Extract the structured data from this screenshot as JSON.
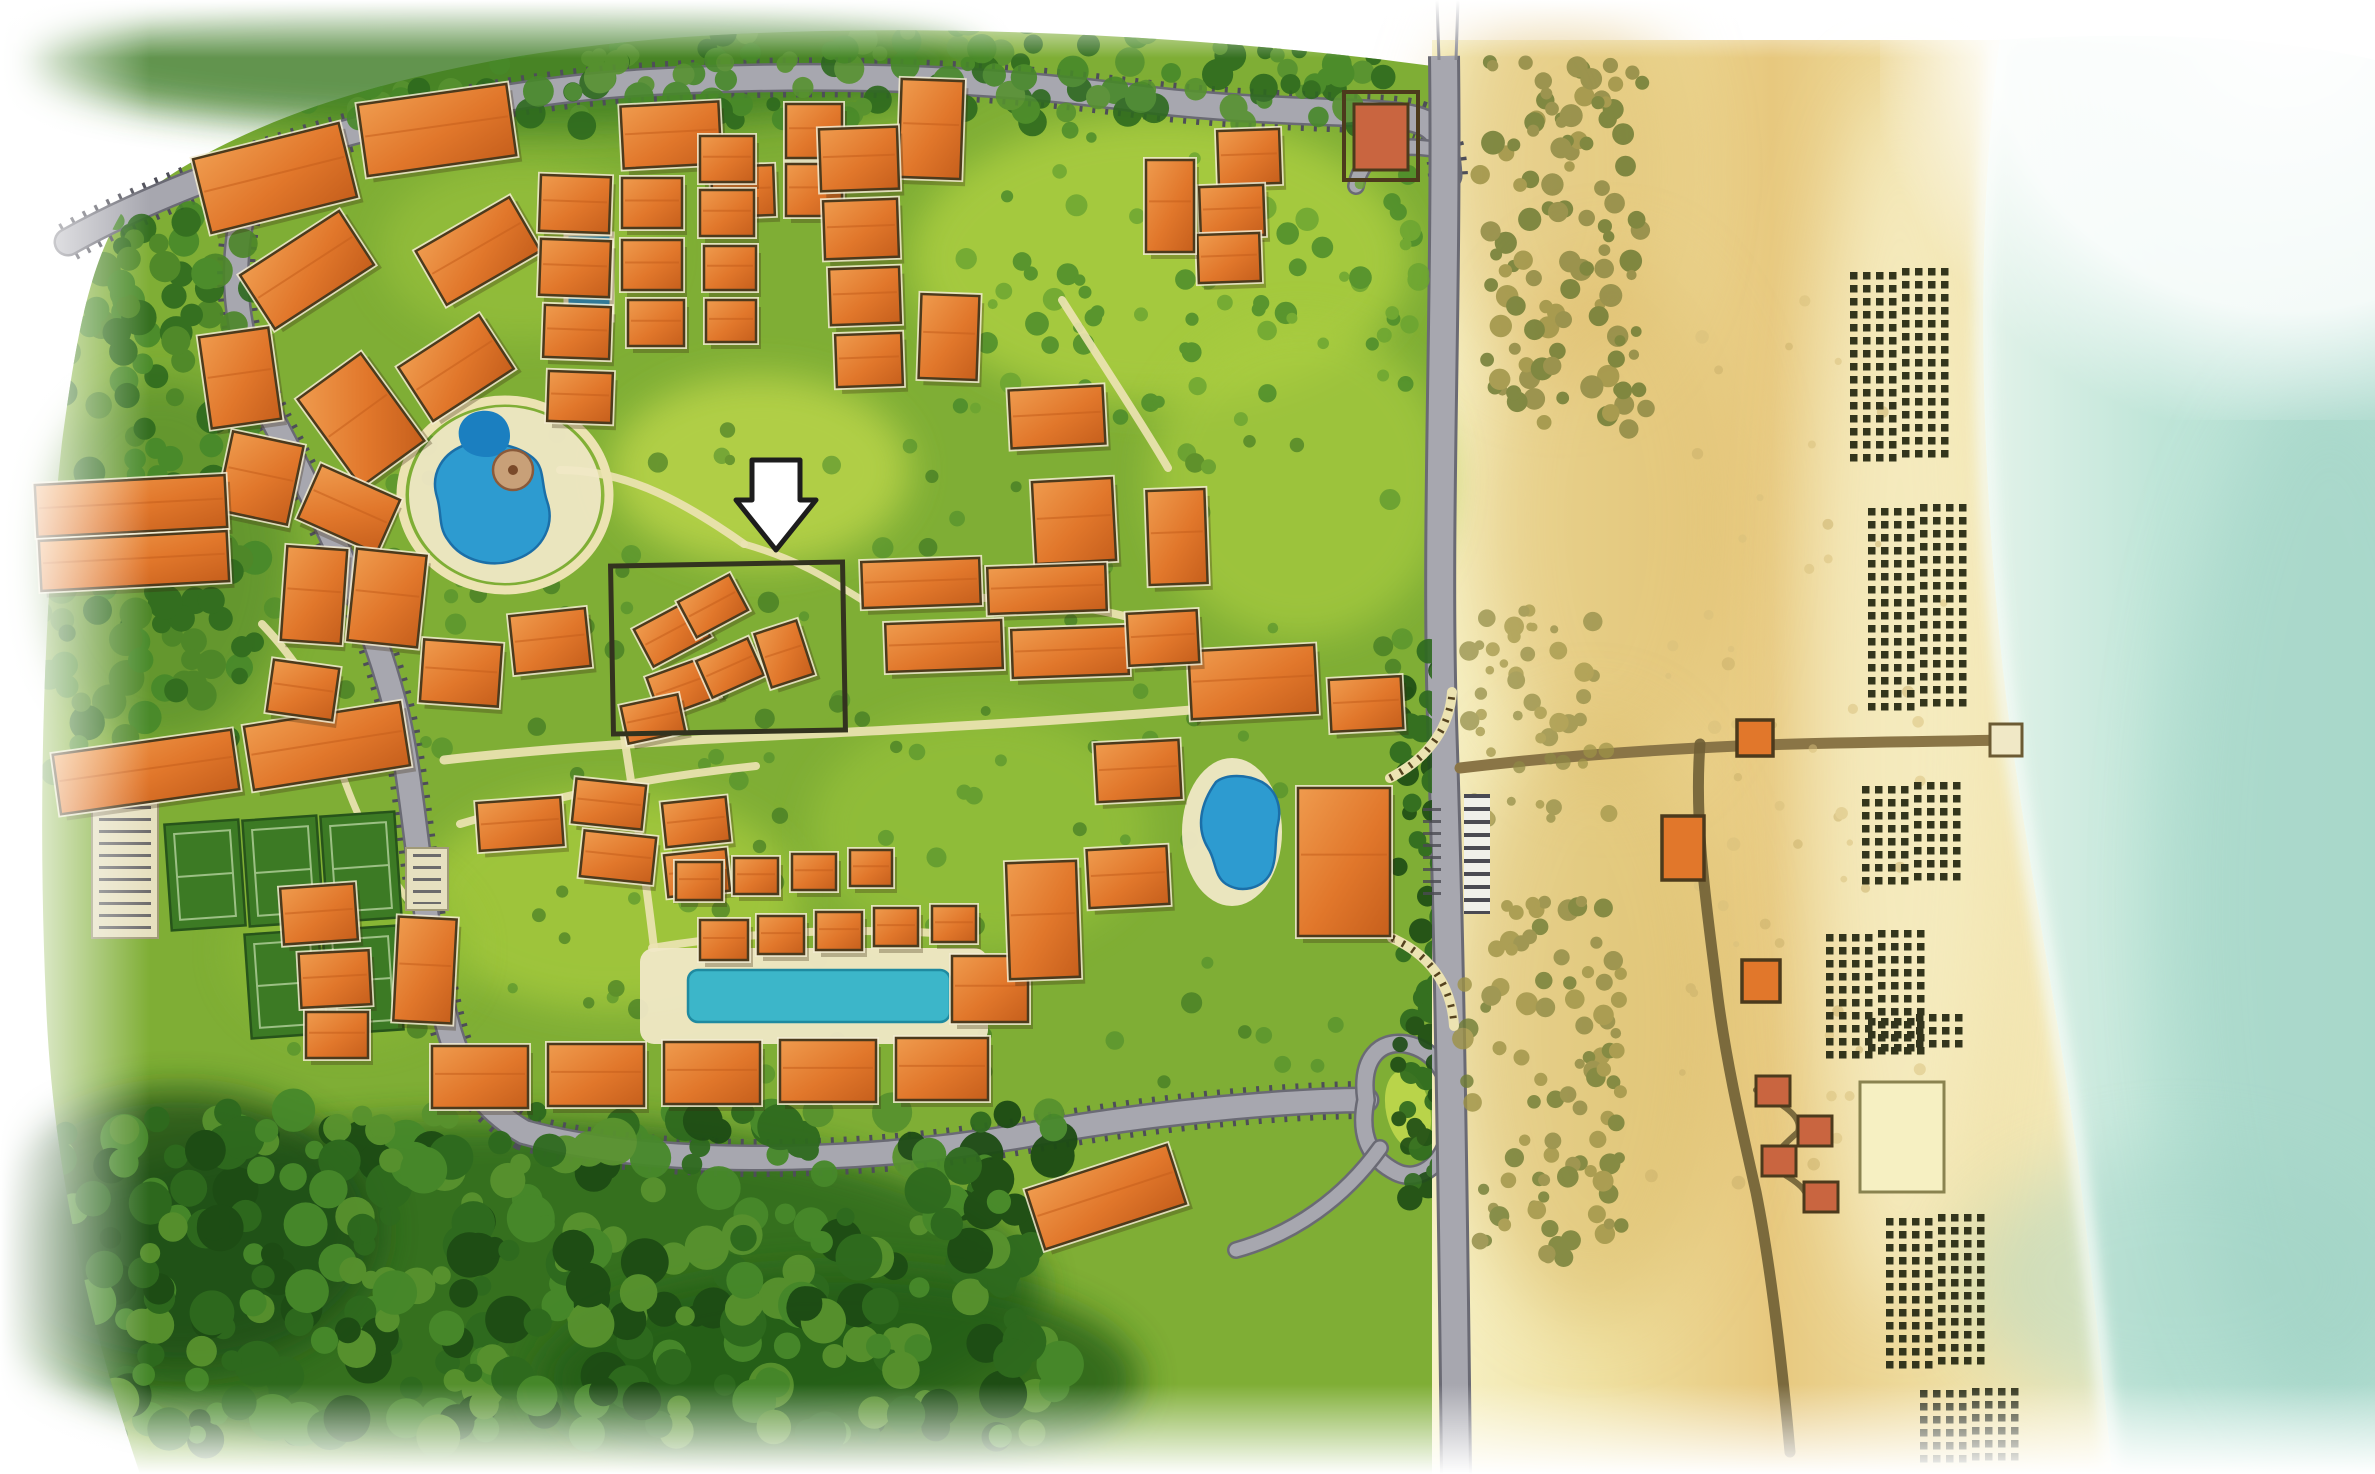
{
  "map": {
    "kind": "illustrated-resort-master-plan",
    "description": "Watercolor aerial site plan of a beachfront resort community with a highlighted parcel marked by a white arrow",
    "annotation": "white-down-arrow-over-highlighted-parcel"
  },
  "colors": {
    "grass": "#7fae35",
    "lawn_bright": "#b9d44a",
    "forest": "#2e6a1e",
    "forest_dark": "#1d4c14",
    "tree": "#47892a",
    "road": "#a7a7af",
    "road_edge": "#6a6a74",
    "park_tick": "#4e4e58",
    "path": "#ece3b2",
    "deck": "#f0e8c6",
    "pool_blue": "#2d9bd0",
    "pool_deep": "#1b6fa8",
    "lap_pool": "#3cb6c9",
    "bldg": "#e1772b",
    "bldg_light": "#ef9b4e",
    "bldg_dark": "#c65f1c",
    "outline": "#4c3a1c",
    "plinth": "#f3ecd2",
    "sand_light": "#f7f2c8",
    "sand_gold": "#e7c87e",
    "dune_olive": "#9e9347",
    "ocean": "#bfe5d8",
    "ocean_deep": "#a5d6c8",
    "foam": "#f4fbf6",
    "umbrella": "#33351c",
    "boardwalk": "#6f5f35",
    "hut": "#c96540",
    "court": "#3c7a24",
    "court_line": "#9cc084",
    "parking_lot": "#e6e0c0",
    "parcel_stroke": "#33331f",
    "arrow_fill": "#ffffff",
    "arrow_stroke": "#1d1d1d"
  },
  "roads": [
    {
      "id": "north-entry-road",
      "d": "M68,242 C200,168 430,94 650,82 C830,72 990,78 1150,100 C1270,114 1370,110 1410,118 C1438,124 1446,138 1448,176",
      "w": 24,
      "ticks": true
    },
    {
      "id": "west-south-loop-road",
      "d": "M252,182 C224,262 234,342 274,422 C320,510 368,602 394,702 C412,770 418,882 438,982 C452,1058 472,1102 524,1132 C644,1166 844,1166 1022,1136 C1162,1110 1302,1100 1366,1100",
      "w": 22,
      "ticks": true
    },
    {
      "id": "roundabout",
      "d": "M1366,1100 C1360,1058 1380,1040 1406,1044 C1438,1050 1454,1080 1452,1118 C1450,1162 1420,1184 1396,1172 C1372,1160 1358,1138 1366,1100",
      "w": 15
    },
    {
      "id": "south-spur",
      "d": "M1380,1148 C1344,1198 1294,1234 1236,1250",
      "w": 13
    },
    {
      "id": "gate-loop",
      "d": "M1448,152 C1398,140 1362,150 1356,186",
      "w": 13
    }
  ],
  "highway": {
    "id": "coastal-highway",
    "d": "M1444,56 C1447,300 1436,520 1442,720 C1448,900 1452,1100 1456,1474",
    "w": 26
  },
  "beach_road": {
    "id": "beach-access-road",
    "d": "M1460,768 C1560,756 1650,750 1738,746 C1830,742 1920,742 2004,740",
    "w": 11
  },
  "paths": [
    {
      "d": "M444,760 C620,740 800,736 960,726 C1100,718 1220,708 1310,700",
      "w": 9
    },
    {
      "d": "M624,736 C636,812 646,880 654,948",
      "w": 8
    },
    {
      "d": "M560,470 C630,470 690,506 744,544",
      "w": 8
    },
    {
      "d": "M864,600 C980,592 1100,600 1186,636",
      "w": 8
    },
    {
      "d": "M460,824 C560,794 660,776 756,766",
      "w": 8
    },
    {
      "d": "M652,948 C760,930 860,928 952,934",
      "w": 8
    },
    {
      "d": "M262,624 C300,664 326,706 338,762",
      "w": 8
    },
    {
      "d": "M1062,300 C1100,360 1140,420 1168,468",
      "w": 8
    },
    {
      "d": "M338,762 C358,822 380,862 408,900",
      "w": 7
    },
    {
      "d": "M744,544 C800,560 830,580 862,600",
      "w": 7
    }
  ],
  "colonnades": [
    {
      "d": "M1390,778 C1432,756 1450,724 1452,692",
      "w": 7
    },
    {
      "d": "M1392,938 C1436,958 1452,992 1454,1026",
      "w": 7
    }
  ],
  "boardwalks": [
    {
      "d": "M1700,744 C1694,822 1706,902 1716,982 C1724,1052 1740,1122 1756,1192 C1770,1262 1782,1362 1790,1452",
      "w": 11
    },
    {
      "d": "M1756,1090 C1790,1108 1802,1118 1798,1132 C1780,1148 1770,1158 1772,1168 C1792,1178 1806,1188 1806,1196",
      "w": 6
    }
  ],
  "buildings_xywhr": [
    [
      200,
      140,
      150,
      76,
      -14
    ],
    [
      362,
      94,
      150,
      72,
      -8
    ],
    [
      622,
      104,
      98,
      62,
      -3
    ],
    [
      712,
      166,
      62,
      50,
      -2
    ],
    [
      786,
      104,
      56,
      54,
      0
    ],
    [
      786,
      164,
      56,
      52,
      0
    ],
    [
      900,
      80,
      62,
      98,
      2
    ],
    [
      248,
      238,
      118,
      64,
      -33
    ],
    [
      424,
      220,
      108,
      62,
      -30
    ],
    [
      322,
      366,
      78,
      108,
      -36
    ],
    [
      408,
      336,
      96,
      64,
      -33
    ],
    [
      205,
      332,
      70,
      92,
      -8
    ],
    [
      224,
      438,
      72,
      80,
      12
    ],
    [
      306,
      480,
      86,
      58,
      24
    ],
    [
      540,
      176,
      70,
      56,
      2
    ],
    [
      540,
      240,
      70,
      56,
      2
    ],
    [
      544,
      306,
      66,
      52,
      2
    ],
    [
      548,
      372,
      64,
      50,
      2
    ],
    [
      622,
      178,
      60,
      50,
      0
    ],
    [
      622,
      240,
      60,
      50,
      0
    ],
    [
      628,
      300,
      56,
      46,
      0
    ],
    [
      700,
      136,
      54,
      46,
      0
    ],
    [
      700,
      190,
      54,
      46,
      0
    ],
    [
      704,
      246,
      52,
      44,
      0
    ],
    [
      706,
      300,
      50,
      42,
      0
    ],
    [
      820,
      128,
      78,
      62,
      -2
    ],
    [
      824,
      200,
      74,
      58,
      -2
    ],
    [
      830,
      268,
      70,
      56,
      -2
    ],
    [
      836,
      334,
      66,
      52,
      -2
    ],
    [
      920,
      295,
      58,
      84,
      2
    ],
    [
      1218,
      130,
      62,
      54,
      -2
    ],
    [
      1200,
      186,
      64,
      50,
      -2
    ],
    [
      1198,
      234,
      62,
      48,
      -2
    ],
    [
      1146,
      160,
      48,
      92,
      0
    ],
    [
      1010,
      388,
      94,
      58,
      -3
    ],
    [
      1034,
      480,
      80,
      82,
      -3
    ],
    [
      1148,
      490,
      58,
      94,
      -2
    ],
    [
      36,
      480,
      190,
      52,
      -3
    ],
    [
      40,
      536,
      188,
      50,
      -3
    ],
    [
      56,
      742,
      180,
      60,
      -8
    ],
    [
      248,
      714,
      158,
      64,
      -9
    ],
    [
      284,
      548,
      60,
      94,
      4
    ],
    [
      352,
      552,
      70,
      92,
      6
    ],
    [
      422,
      642,
      78,
      62,
      4
    ],
    [
      512,
      612,
      76,
      58,
      -6
    ],
    [
      270,
      664,
      66,
      52,
      8
    ],
    [
      282,
      886,
      74,
      56,
      -4
    ],
    [
      300,
      952,
      70,
      54,
      -3
    ],
    [
      396,
      918,
      58,
      104,
      3
    ],
    [
      306,
      1012,
      62,
      46,
      0
    ],
    [
      640,
      612,
      64,
      42,
      -28
    ],
    [
      684,
      586,
      58,
      40,
      -28
    ],
    [
      652,
      666,
      62,
      42,
      -20
    ],
    [
      702,
      648,
      56,
      40,
      -24
    ],
    [
      624,
      700,
      58,
      38,
      -12
    ],
    [
      762,
      626,
      44,
      56,
      -18
    ],
    [
      862,
      560,
      118,
      46,
      -2
    ],
    [
      988,
      566,
      118,
      46,
      -2
    ],
    [
      886,
      622,
      116,
      48,
      -2
    ],
    [
      1012,
      628,
      116,
      48,
      -2
    ],
    [
      1190,
      648,
      126,
      68,
      -3
    ],
    [
      1330,
      678,
      72,
      52,
      -3
    ],
    [
      478,
      800,
      84,
      48,
      -4
    ],
    [
      574,
      782,
      70,
      44,
      6
    ],
    [
      582,
      834,
      72,
      46,
      6
    ],
    [
      664,
      800,
      64,
      44,
      -6
    ],
    [
      666,
      852,
      62,
      42,
      -6
    ],
    [
      676,
      862,
      46,
      38,
      0
    ],
    [
      734,
      858,
      44,
      36,
      0
    ],
    [
      792,
      854,
      44,
      36,
      0
    ],
    [
      850,
      850,
      42,
      36,
      0
    ],
    [
      700,
      920,
      48,
      40,
      0
    ],
    [
      758,
      916,
      46,
      38,
      0
    ],
    [
      816,
      912,
      46,
      38,
      0
    ],
    [
      874,
      908,
      44,
      38,
      0
    ],
    [
      932,
      906,
      44,
      36,
      0
    ],
    [
      432,
      1046,
      96,
      62,
      0
    ],
    [
      548,
      1044,
      96,
      62,
      0
    ],
    [
      664,
      1042,
      96,
      62,
      0
    ],
    [
      780,
      1040,
      96,
      62,
      0
    ],
    [
      896,
      1038,
      92,
      62,
      0
    ],
    [
      952,
      956,
      76,
      66,
      0
    ],
    [
      1128,
      612,
      70,
      52,
      -3
    ],
    [
      1096,
      742,
      84,
      58,
      -3
    ],
    [
      1088,
      848,
      80,
      58,
      -3
    ],
    [
      1008,
      862,
      70,
      116,
      -2
    ],
    [
      1298,
      788,
      92,
      148,
      0
    ],
    [
      1032,
      1166,
      148,
      62,
      -18
    ]
  ],
  "tennis_courts_xywhr": [
    [
      168,
      822,
      74,
      106,
      -4
    ],
    [
      246,
      818,
      74,
      106,
      -4
    ],
    [
      324,
      814,
      74,
      106,
      -4
    ],
    [
      248,
      932,
      74,
      104,
      -4
    ],
    [
      326,
      928,
      74,
      104,
      -4
    ]
  ],
  "parking_lots": [
    {
      "x": 92,
      "y": 788,
      "w": 66,
      "h": 150
    },
    {
      "x": 406,
      "y": 848,
      "w": 42,
      "h": 62
    }
  ],
  "umbrella_blocks": [
    [
      1850,
      272,
      4,
      15
    ],
    [
      1902,
      268,
      4,
      15
    ],
    [
      1868,
      508,
      4,
      16
    ],
    [
      1920,
      504,
      4,
      16
    ],
    [
      1862,
      786,
      4,
      8
    ],
    [
      1914,
      782,
      4,
      8
    ],
    [
      1826,
      934,
      4,
      10
    ],
    [
      1878,
      930,
      4,
      10
    ],
    [
      1868,
      1018,
      4,
      3
    ],
    [
      1916,
      1014,
      4,
      3
    ],
    [
      1886,
      1218,
      4,
      12
    ],
    [
      1938,
      1214,
      4,
      12
    ],
    [
      1920,
      1390,
      4,
      6
    ],
    [
      1972,
      1388,
      4,
      6
    ]
  ],
  "beach_structures": {
    "gatehouse_outer": {
      "x": 1344,
      "y": 92,
      "w": 74,
      "h": 88
    },
    "gatehouse_inner": {
      "x": 1354,
      "y": 104,
      "w": 54,
      "h": 66
    },
    "pavilions": [
      {
        "x": 1737,
        "y": 720,
        "w": 36,
        "h": 36
      },
      {
        "x": 1662,
        "y": 816,
        "w": 42,
        "h": 64
      },
      {
        "x": 1742,
        "y": 960,
        "w": 38,
        "h": 42
      }
    ],
    "huts": [
      {
        "x": 1756,
        "y": 1076,
        "w": 34,
        "h": 30
      },
      {
        "x": 1798,
        "y": 1116,
        "w": 34,
        "h": 30
      },
      {
        "x": 1762,
        "y": 1146,
        "w": 34,
        "h": 30
      },
      {
        "x": 1804,
        "y": 1182,
        "w": 34,
        "h": 30
      }
    ],
    "pier_deck": {
      "x": 1990,
      "y": 724,
      "w": 32,
      "h": 32
    },
    "event_lawn": {
      "x": 1860,
      "y": 1082,
      "w": 84,
      "h": 110
    }
  },
  "highlighted_parcel": {
    "x": 612,
    "y": 564,
    "w": 232,
    "h": 168,
    "stroke_w": 5
  },
  "arrow": {
    "points": "752,460 800,460 800,500 816,500 776,550 736,500 752,500",
    "stroke_w": 5
  },
  "texture_regions": [
    {
      "x": 60,
      "y": 1110,
      "w": 1010,
      "h": 330,
      "n": 360,
      "rmin": 9,
      "rmax": 24,
      "cols": [
        "forest",
        "forest_dark",
        "tree",
        "#58922e"
      ],
      "clip": true,
      "op": 0.95,
      "seed": 11
    },
    {
      "x": 40,
      "y": 200,
      "w": 220,
      "h": 580,
      "n": 150,
      "rmin": 8,
      "rmax": 18,
      "cols": [
        "forest",
        "tree",
        "#4c8628"
      ],
      "clip": true,
      "op": 0.9,
      "seed": 21
    },
    {
      "x": 90,
      "y": 18,
      "w": 1300,
      "h": 108,
      "n": 200,
      "rmin": 7,
      "rmax": 16,
      "cols": [
        "forest",
        "tree",
        "#579230"
      ],
      "clip": true,
      "op": 0.9,
      "seed": 31
    },
    {
      "x": 960,
      "y": 130,
      "w": 470,
      "h": 300,
      "n": 80,
      "rmin": 5,
      "rmax": 12,
      "cols": [
        "tree",
        "#6aa431"
      ],
      "clip": true,
      "op": 0.8,
      "seed": 41
    },
    {
      "x": 260,
      "y": 430,
      "w": 1150,
      "h": 660,
      "n": 170,
      "rmin": 5,
      "rmax": 11,
      "cols": [
        "forest",
        "tree"
      ],
      "clip": true,
      "op": 0.55,
      "seed": 51
    },
    {
      "x": 1398,
      "y": 640,
      "w": 60,
      "h": 560,
      "n": 90,
      "rmin": 7,
      "rmax": 14,
      "cols": [
        "forest",
        "forest_dark"
      ],
      "clip": true,
      "op": 0.9,
      "seed": 61
    },
    {
      "x": 1478,
      "y": 60,
      "w": 170,
      "h": 370,
      "n": 110,
      "rmin": 5,
      "rmax": 12,
      "cols": [
        "dune_olive",
        "#8f8a45",
        "#6f7c35"
      ],
      "clip": false,
      "op": 0.85,
      "seed": 71
    },
    {
      "x": 1468,
      "y": 610,
      "w": 150,
      "h": 210,
      "n": 50,
      "rmin": 4,
      "rmax": 10,
      "cols": [
        "dune_olive",
        "#8f8a45"
      ],
      "clip": false,
      "op": 0.7,
      "seed": 81
    },
    {
      "x": 1462,
      "y": 900,
      "w": 160,
      "h": 360,
      "n": 95,
      "rmin": 5,
      "rmax": 11,
      "cols": [
        "dune_olive",
        "#8f8a45",
        "#6f7c35"
      ],
      "clip": false,
      "op": 0.8,
      "seed": 91
    },
    {
      "x": 1650,
      "y": 300,
      "w": 300,
      "h": 900,
      "n": 60,
      "rmin": 3,
      "rmax": 7,
      "cols": [
        "#d8c07c",
        "#c9b06a"
      ],
      "clip": false,
      "op": 0.5,
      "seed": 101
    }
  ]
}
